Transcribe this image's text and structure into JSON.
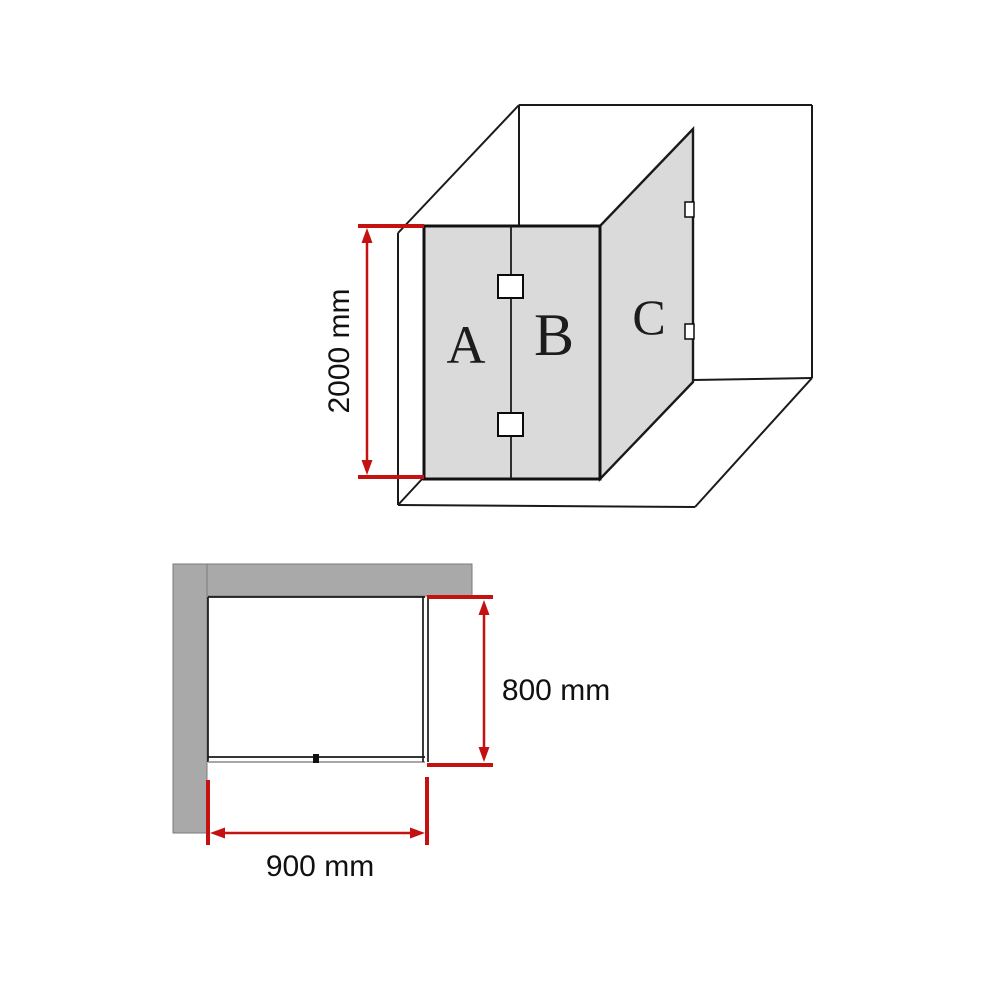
{
  "title": "Shower screen technical drawing",
  "perspective_view": {
    "panels": [
      {
        "label": "A"
      },
      {
        "label": "B"
      },
      {
        "label": "C"
      }
    ],
    "height_dimension": {
      "value": 2000,
      "unit": "mm",
      "label": "2000 mm"
    }
  },
  "plan_view": {
    "width_dimension": {
      "value": 900,
      "unit": "mm",
      "label": "900 mm"
    },
    "depth_dimension": {
      "value": 800,
      "unit": "mm",
      "label": "800 mm"
    }
  },
  "colors": {
    "background": "#ffffff",
    "line_black": "#1a1a1a",
    "glass_gray": "#dadada",
    "wall_gray": "#a9a9a9",
    "dimension_red": "#c41111"
  }
}
